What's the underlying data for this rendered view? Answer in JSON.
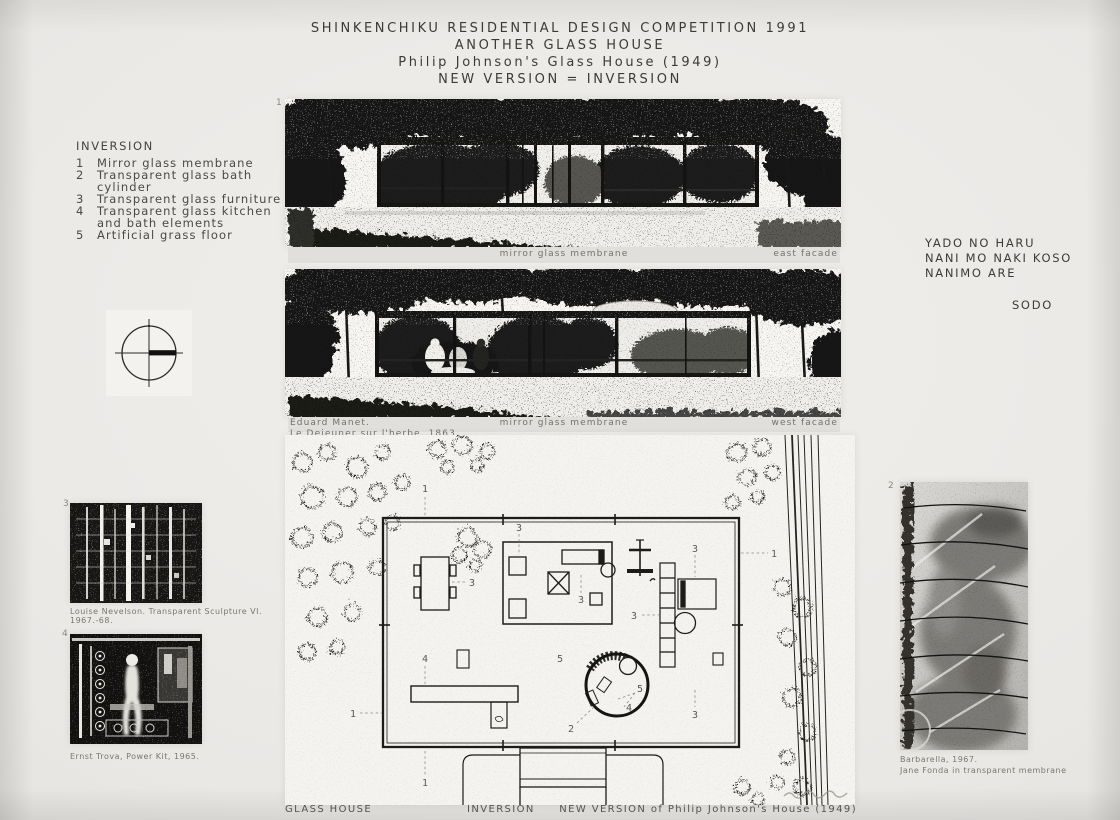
{
  "header": {
    "line1": "SHINKENCHIKU RESIDENTIAL DESIGN COMPETITION 1991",
    "line2": "ANOTHER GLASS HOUSE",
    "line3": "Philip Johnson's Glass House (1949)",
    "line4": "NEW VERSION = INVERSION"
  },
  "inversion": {
    "title": "INVERSION",
    "items": [
      {
        "num": "1",
        "label": "Mirror glass membrane"
      },
      {
        "num": "2",
        "label": "Transparent glass bath cylinder"
      },
      {
        "num": "3",
        "label": "Transparent glass furniture"
      },
      {
        "num": "4",
        "label": "Transparent glass kitchen",
        "label2": "and bath elements"
      },
      {
        "num": "5",
        "label": "Artificial grass floor"
      }
    ]
  },
  "poem": {
    "line1": "YADO NO HARU",
    "line2": "NANI MO NAKI KOSO",
    "line3": "NANIMO ARE",
    "signature": "SODO"
  },
  "photo_east": {
    "figure_number": "1",
    "caption_center": "mirror glass membrane",
    "caption_right": "east facade"
  },
  "photo_west": {
    "caption_left_line1": "Eduard Manet.",
    "caption_left_line2": "Le Dejeuner sur l'herbe, 1863.",
    "caption_center": "mirror glass membrane",
    "caption_right": "west facade"
  },
  "artworks": {
    "nevelson": {
      "figure_number": "3",
      "caption": "Louise Nevelson. Transparent Sculpture VI. 1967.-68."
    },
    "trova": {
      "figure_number": "4",
      "caption": "Ernst Trova, Power Kit, 1965."
    },
    "barbarella": {
      "figure_number": "2",
      "caption_line1": "Barbarella, 1967.",
      "caption_line2": "Jane Fonda in transparent membrane"
    }
  },
  "plan": {
    "numbers": {
      "n1": "1",
      "n2": "2",
      "n3": "3",
      "n4": "4",
      "n5": "5"
    }
  },
  "footer": {
    "left": "GLASS HOUSE",
    "center": "INVERSION",
    "right": "NEW VERSION of Philip Johnson's House (1949)"
  },
  "colors": {
    "paper": "#eae8e5",
    "ink": "#1a1a18",
    "caption_gray": "#74726d",
    "strip": "#e1dfdb"
  }
}
